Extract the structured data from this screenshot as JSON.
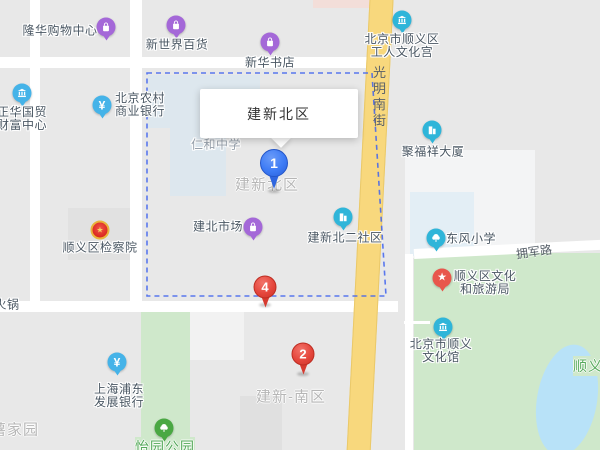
{
  "map": {
    "colors": {
      "base": "#e8e8e8",
      "road_white": "#ffffff",
      "road_yellow": "#f8d87d",
      "park_green": "#cfe8cb",
      "water_blue": "#b8e2f8",
      "boundary_blue": "#3f63ee",
      "marker_blue": "#3d7bf5",
      "marker_red": "#e5463c",
      "pin_purple": "#a468d8",
      "pin_teal": "#2fb5d9",
      "pin_lightblue": "#45b3e8",
      "pin_red": "#e8564c",
      "pin_green": "#4aa843",
      "label_dark": "#4a5763",
      "label_gray": "#b6b6b6",
      "label_green": "#55a95a"
    },
    "callout": {
      "title": "建新北区"
    },
    "streets": {
      "vertical": {
        "name": "光明南街"
      },
      "horizontal": {
        "name": "拥军路"
      }
    },
    "area_labels": [
      {
        "id": "jianxin-beiqu",
        "text": "建新北区",
        "x": 267,
        "y": 184,
        "style": "gray"
      },
      {
        "id": "jianxin-nanqu",
        "text": "建新-南区",
        "x": 291,
        "y": 396,
        "style": "gray"
      },
      {
        "id": "shujiayuan",
        "text": "薯家园",
        "x": 15,
        "y": 429,
        "style": "gray"
      },
      {
        "id": "yiyuan-gongyuan",
        "text": "怡园公园",
        "x": 165,
        "y": 447,
        "style": "green"
      },
      {
        "id": "shunyi-partial",
        "text": "顺义",
        "x": 588,
        "y": 366,
        "style": "green"
      }
    ],
    "pois": [
      {
        "id": "longhua-shopping-center",
        "lines": [
          "隆华购物中心"
        ],
        "pin": {
          "x": 106,
          "y": 27,
          "color": "purple",
          "icon": "bag"
        },
        "label": {
          "x": 60,
          "y": 31
        }
      },
      {
        "id": "xinshijie-baihuo",
        "lines": [
          "新世界百货"
        ],
        "pin": {
          "x": 176,
          "y": 25,
          "color": "purple",
          "icon": "bag"
        },
        "label": {
          "x": 177,
          "y": 45
        }
      },
      {
        "id": "xinhua-bookstore",
        "lines": [
          "新华书店"
        ],
        "pin": {
          "x": 270,
          "y": 42,
          "color": "purple",
          "icon": "bag"
        },
        "label": {
          "x": 270,
          "y": 63
        }
      },
      {
        "id": "workers-culture-palace",
        "lines": [
          "北京市顺义区",
          "工人文化宫"
        ],
        "pin": {
          "x": 402,
          "y": 20,
          "color": "teal",
          "icon": "columns"
        },
        "label": {
          "x": 402,
          "y": 46
        }
      },
      {
        "id": "zhenghua-guomao",
        "lines": [
          "正华国贸",
          "财富中心"
        ],
        "pin": {
          "x": 22,
          "y": 93,
          "color": "lightblue",
          "icon": "columns"
        },
        "label": {
          "x": 22,
          "y": 119
        }
      },
      {
        "id": "rural-commercial-bank",
        "lines": [
          "北京农村",
          "商业银行"
        ],
        "pin": {
          "x": 102,
          "y": 105,
          "color": "lightblue",
          "icon": "yen"
        },
        "label": {
          "x": 140,
          "y": 105
        }
      },
      {
        "id": "renhe-middle-school",
        "lines": [
          "仁和中学"
        ],
        "pin": null,
        "label": {
          "x": 216,
          "y": 145,
          "style": "gray"
        }
      },
      {
        "id": "jufuxiang-building",
        "lines": [
          "聚福祥大厦"
        ],
        "pin": {
          "x": 432,
          "y": 130,
          "color": "teal",
          "icon": "building"
        },
        "label": {
          "x": 433,
          "y": 152
        }
      },
      {
        "id": "jianbei-market",
        "lines": [
          "建北市场"
        ],
        "pin": {
          "x": 253,
          "y": 227,
          "color": "purple",
          "icon": "bag"
        },
        "label": {
          "x": 218,
          "y": 227
        }
      },
      {
        "id": "jianxinbei-er-shequ",
        "lines": [
          "建新北二社区"
        ],
        "pin": {
          "x": 343,
          "y": 217,
          "color": "teal",
          "icon": "building"
        },
        "label": {
          "x": 345,
          "y": 238
        }
      },
      {
        "id": "shunyi-procuratorate",
        "lines": [
          "顺义区检察院"
        ],
        "pin": {
          "x": 100,
          "y": 230,
          "color": "emblem",
          "icon": "emblem"
        },
        "label": {
          "x": 100,
          "y": 248
        }
      },
      {
        "id": "dongfeng-primary-school",
        "lines": [
          "东风小学"
        ],
        "pin": {
          "x": 436,
          "y": 238,
          "color": "teal",
          "icon": "tree"
        },
        "label": {
          "x": 471,
          "y": 239
        }
      },
      {
        "id": "culture-tourism-bureau",
        "lines": [
          "顺义区文化",
          "和旅游局"
        ],
        "pin": {
          "x": 442,
          "y": 278,
          "color": "red",
          "icon": "star"
        },
        "label": {
          "x": 485,
          "y": 283
        }
      },
      {
        "id": "shunyi-culture-center",
        "lines": [
          "北京市顺义",
          "文化馆"
        ],
        "pin": {
          "x": 443,
          "y": 327,
          "color": "teal",
          "icon": "columns"
        },
        "label": {
          "x": 441,
          "y": 351
        }
      },
      {
        "id": "pudong-development-bank",
        "lines": [
          "上海浦东",
          "发展银行"
        ],
        "pin": {
          "x": 117,
          "y": 362,
          "color": "lightblue",
          "icon": "yen"
        },
        "label": {
          "x": 119,
          "y": 396
        }
      },
      {
        "id": "huoguo",
        "lines": [
          "火锅"
        ],
        "pin": null,
        "label": {
          "x": 7,
          "y": 305
        }
      },
      {
        "id": "yiyuan-park-pin",
        "lines": [],
        "pin": {
          "x": 164,
          "y": 428,
          "color": "green",
          "icon": "tree"
        },
        "label": null
      }
    ],
    "markers": [
      {
        "id": "marker-1",
        "number": "1",
        "color": "blue",
        "x": 274,
        "y": 163,
        "tip_y": 191
      },
      {
        "id": "marker-4",
        "number": "4",
        "color": "red",
        "x": 265,
        "y": 287,
        "tip_y": 305
      },
      {
        "id": "marker-2",
        "number": "2",
        "color": "red",
        "x": 303,
        "y": 354,
        "tip_y": 374
      }
    ]
  }
}
